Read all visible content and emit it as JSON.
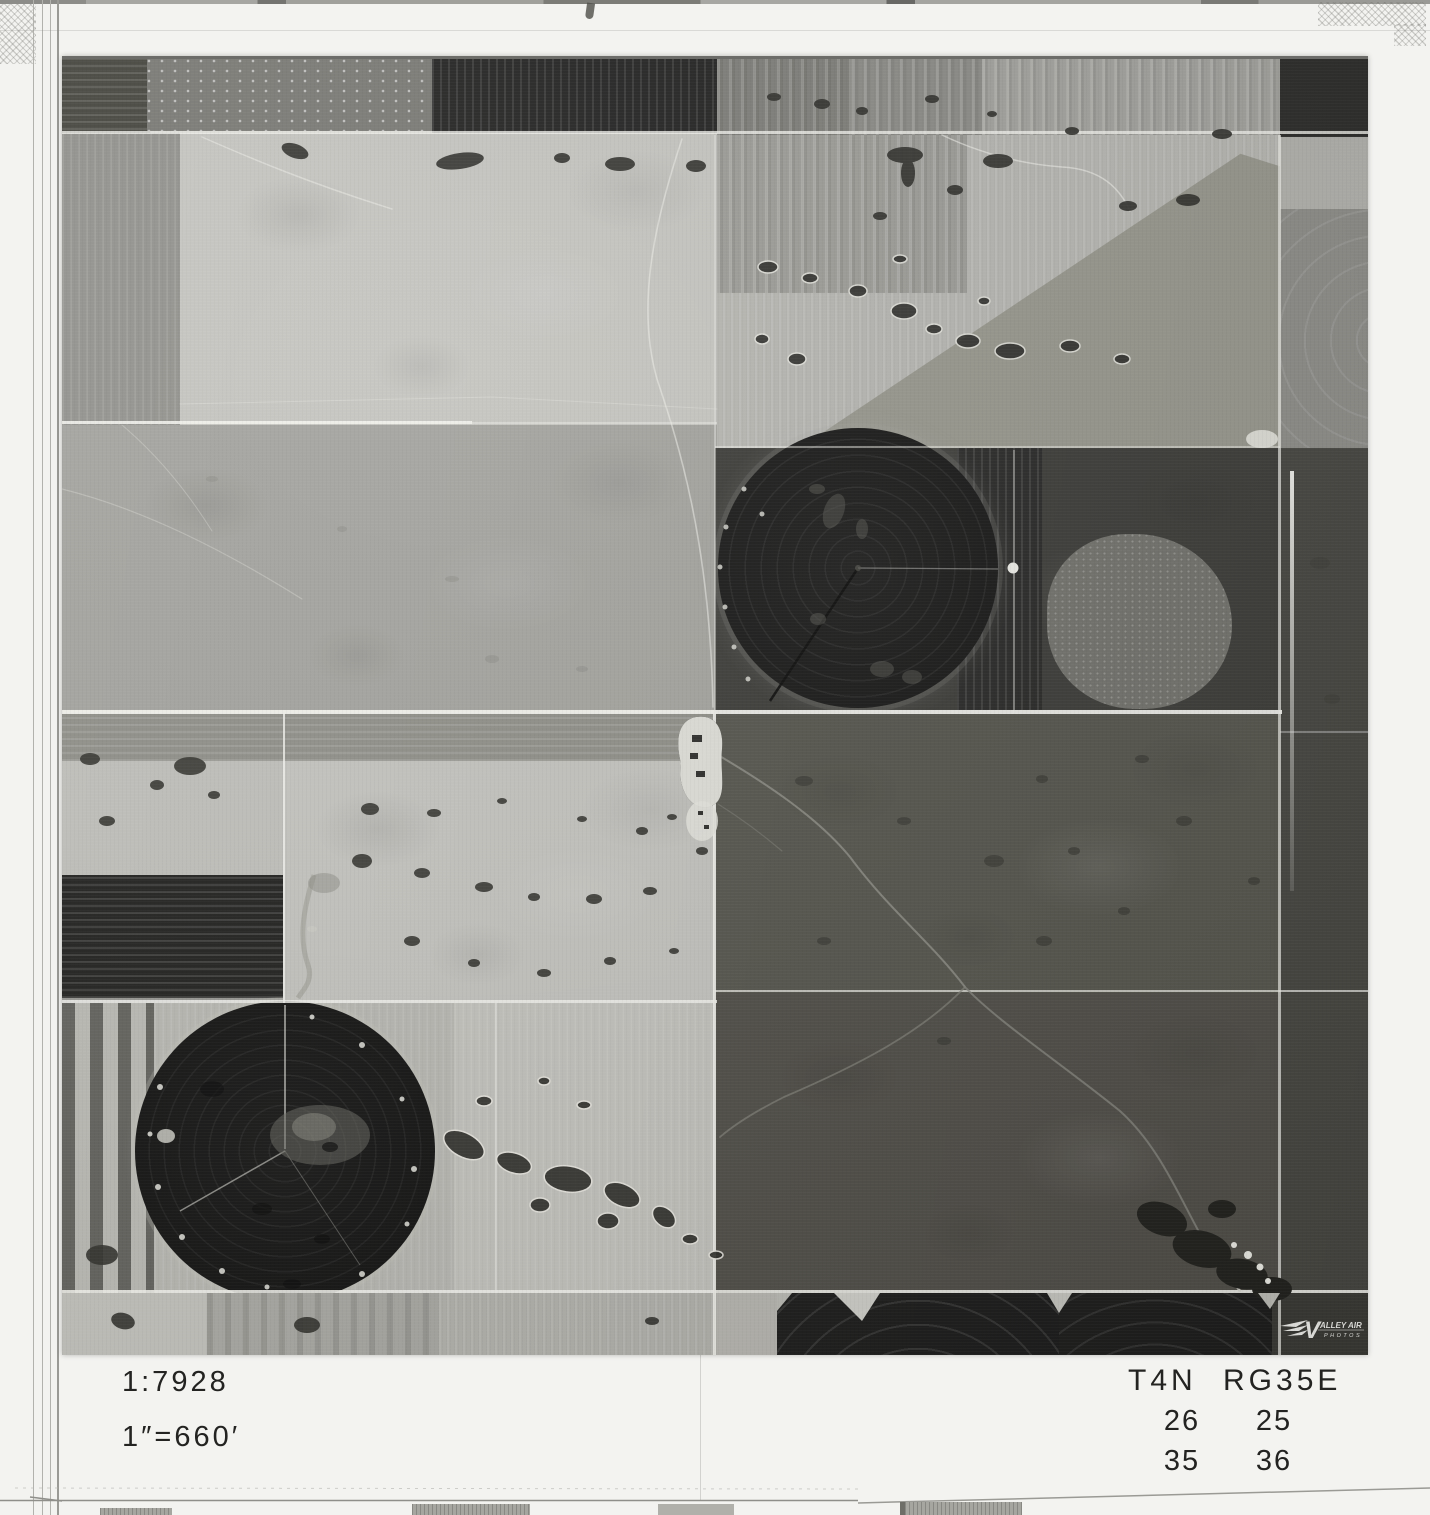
{
  "annotations": {
    "scale_ratio": "1:7928",
    "scale_equivalence": "1″=660′",
    "township_range": "T4N RG35E",
    "sections": [
      [
        "26",
        "25"
      ],
      [
        "35",
        "36"
      ]
    ]
  },
  "logo": {
    "name": "Valley Air Photos",
    "initial": "V",
    "rest": "ALLEY AIR",
    "line2": "PHOTOS"
  },
  "colors": {
    "paper": "#f3f3f0",
    "ink": "#232321",
    "road": "#f5f5f0",
    "photo_base": "#9c9c97",
    "photo_light": "#c6c6c1",
    "photo_dark": "#3e3e3a",
    "pivot_black": "#1a1a19",
    "logo_white": "#f2f2ee"
  }
}
